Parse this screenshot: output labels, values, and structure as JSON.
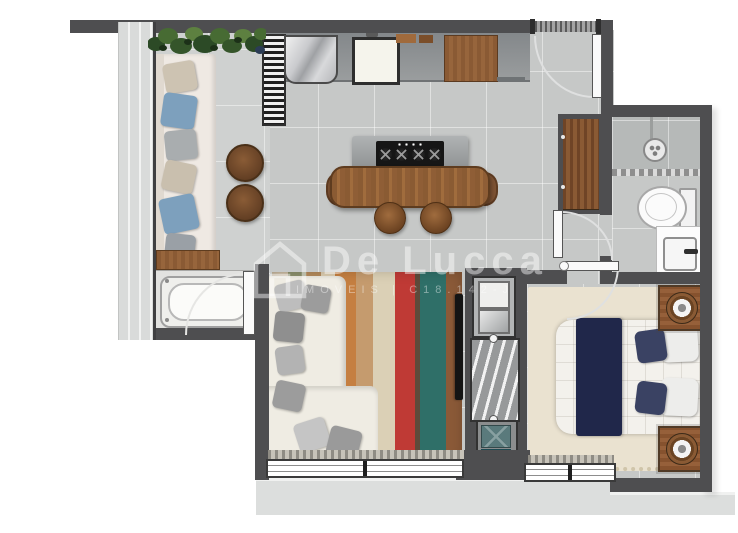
{
  "watermark": {
    "brand": "De Lucca",
    "subtitle": "IMOVEIS",
    "divider": "|",
    "registration": "C18.142-J"
  },
  "palette": {
    "wall": "#4e4e50",
    "floor_tile": "#c6c8c7",
    "balcony_floor": "#cfd1d0",
    "shower_floor": "#b6b9b8",
    "counter_gray": "#8f9293",
    "wood_brown": "#8a5a34",
    "sofa_cream": "#efece3",
    "bed_navy": "#20274a",
    "pillow_navy": "#3a4263",
    "rug_red": "#bf3a35",
    "rug_teal": "#2f6f68",
    "laundry_teal": "#2e6b75",
    "plant_green": "#476b33",
    "bedroom_rug": "#eae2d0"
  },
  "rooms": {
    "balcony": [
      "planter",
      "outdoor-sofa",
      "side-tables",
      "bathtub",
      "glass-railing"
    ],
    "kitchen": [
      "shelf-unit",
      "fridge",
      "sink",
      "cutting-board",
      "wood-cabinet",
      "cooktop-island",
      "dining-table",
      "stools",
      "chairs"
    ],
    "living_room": [
      "l-shaped-sofa",
      "striped-rug",
      "tv-panel",
      "sliding-window"
    ],
    "laundry": [
      "utility-sink",
      "washer",
      "drying-rack",
      "baskets"
    ],
    "bathroom": [
      "shower",
      "glass-partition",
      "toilet",
      "vanity-sink"
    ],
    "hall": [
      "entry-door",
      "doormat",
      "wardrobe"
    ],
    "bedroom": [
      "double-bed",
      "navy-runner",
      "pillows",
      "nightstands",
      "lamps",
      "rug",
      "sliding-window"
    ]
  }
}
